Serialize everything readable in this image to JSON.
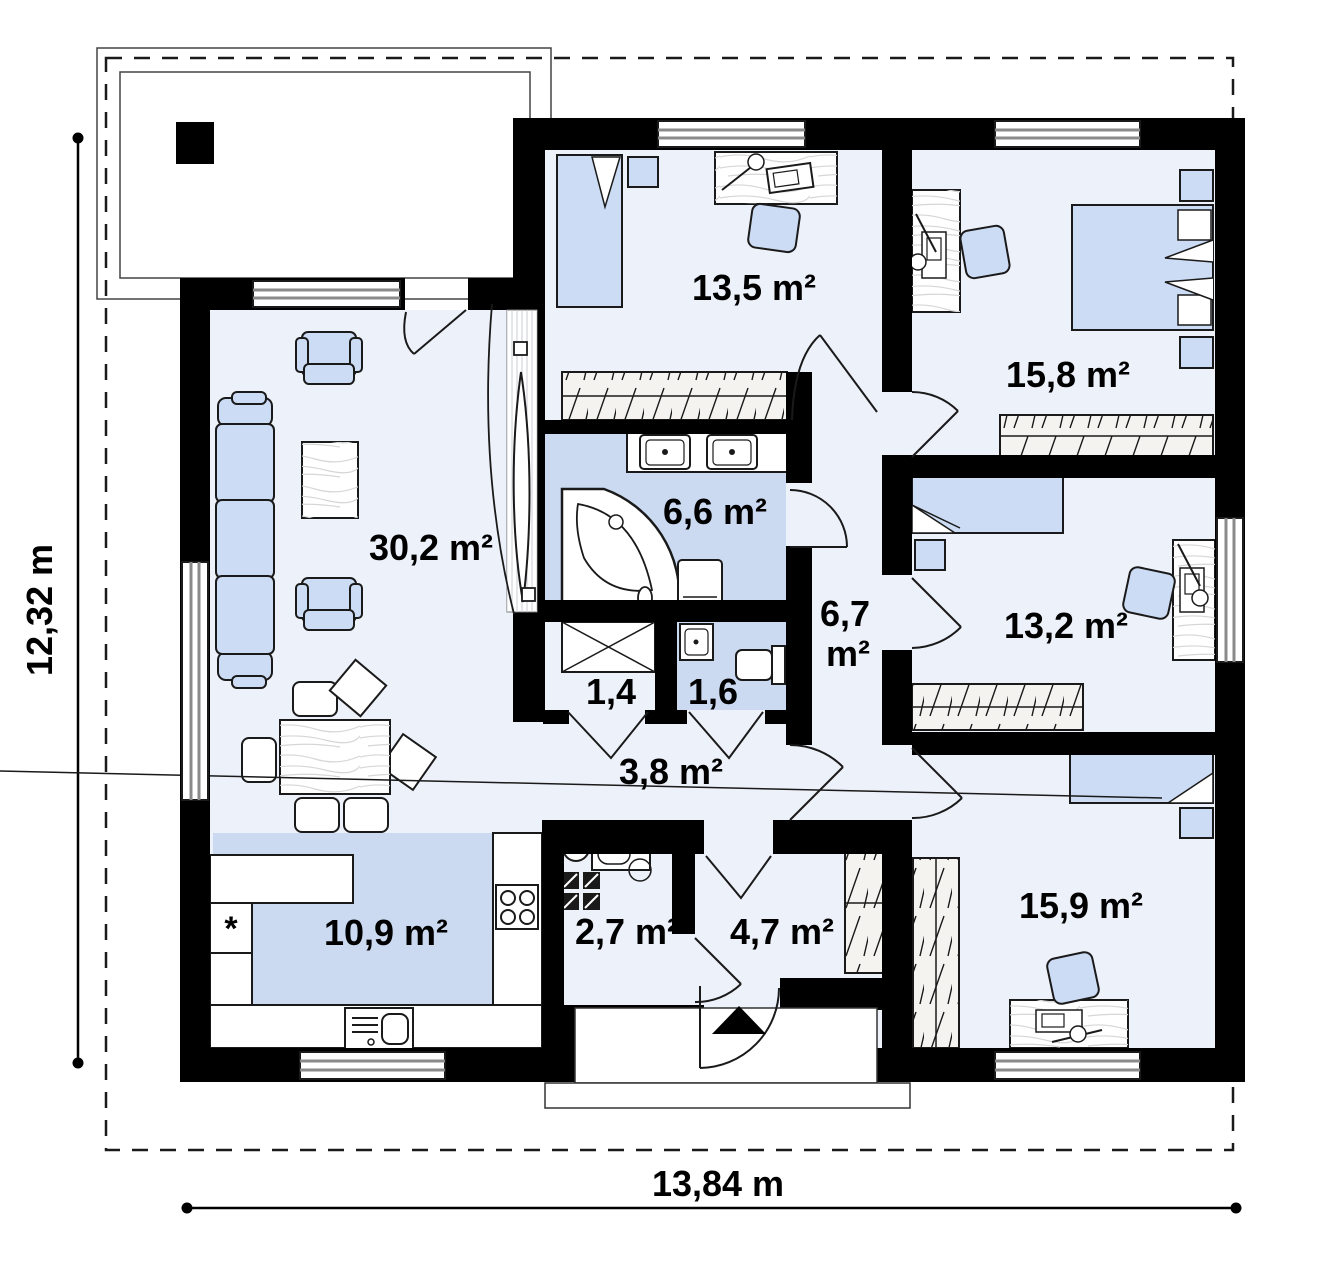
{
  "plan": {
    "rooms": {
      "living": {
        "label": "30,2 m²"
      },
      "kitchen": {
        "label": "10,9 m²"
      },
      "bedroom_top": {
        "label": "13,5 m²"
      },
      "bedroom_right": {
        "label": "15,8 m²"
      },
      "bathroom": {
        "label": "6,6 m²"
      },
      "hall": {
        "label_value": "6,7",
        "label_unit": "m²"
      },
      "closet": {
        "label": "1,4"
      },
      "wc": {
        "label": "1,6"
      },
      "corridor": {
        "label": "3,8 m²"
      },
      "room_middle": {
        "label": "13,2 m²"
      },
      "utility": {
        "label": "2,7 m²"
      },
      "entry": {
        "label": "4,7 m²"
      },
      "bedroom_bottom": {
        "label": "15,9 m²"
      }
    },
    "dimensions": {
      "total_width": "13,84 m",
      "total_depth": "12,32 m"
    },
    "symbols": {
      "kitchen_star": "*"
    },
    "colors": {
      "wall": "#000000",
      "floor": "#edf1fa",
      "wet_floor": "#cbdaf1",
      "upholstery": "#ccdcf4",
      "window_stripe": "#8a8a8a"
    }
  }
}
